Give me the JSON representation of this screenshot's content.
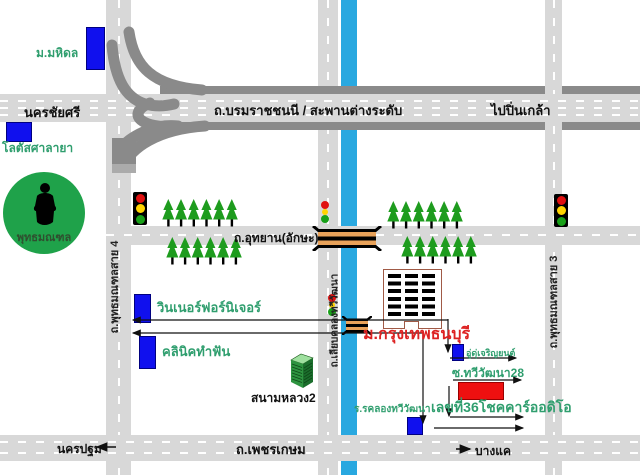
{
  "roads": {
    "nakhon_chai_si": "นครชัยศรี",
    "borommaratchachonnani": "ถ.บรมราชชนนี   /   สะพานต่างระดับ",
    "to_pin_klao": "ไปปิ่นเกล้า",
    "utthayan": "ถ.อุทยาน(อักษะ)",
    "phutthamonthon_sai_4": "ถ.พุทธมณฑลสาย 4",
    "phutthamonthon_sai_3": "ถ.พุทธมณฑลสาย 3",
    "liap_khlong_thawiwatthana": "ถ.เลียบคลองทวีวัฒนา",
    "phetkasem": "ถ.เพชรเกษม",
    "to_nakhon_pathom": "นครปฐม",
    "to_bang_khae": "บางแค"
  },
  "landmarks": {
    "mahidol_university": "ม.มหิดล",
    "lotus_salaya": "โลตัสศาลายา",
    "phutthamonthon": "พุทธมณฑล",
    "winner_furniture": "วินเนอร์ฟอร์นิเจอร์",
    "dental_clinic": "คลินิคทำฟัน",
    "sanam_luang_2": "สนามหลวง2",
    "bangkok_thonburi_university": "ม.กรุงเทพธนบุรี",
    "garage": "อู่ดุ่เจริญยนต์",
    "soi_thawiwatthana_28": "ซ.ทวีวัฒนา28",
    "no36_chok_car_audio": "เลขที่36โชคคาร์ออดิโอ",
    "khlong_thawiwatthana_school": "ร.รคลองทวีวัฒนา"
  },
  "icons": {
    "traffic_light": "red-yellow-green stacked circles",
    "pine_tree": "green triangle tree",
    "buddha_statue": "black silhouette in green circle",
    "bridge": "orange deck with black rails",
    "building_3d": "green isometric building"
  },
  "colors": {
    "canal_blue": "#29A8E0",
    "road_gray": "#D8D8D8",
    "highway_dark_gray": "#8A8A8A",
    "landmark_blue": "#1010EE",
    "destination_red": "#EE1010",
    "label_green": "#2F9E6E",
    "university_label_red": "#DD2222",
    "tree_green": "#1E9C1E",
    "buddha_circle_green": "#1FA24A",
    "bridge_orange": "#E8A25A"
  }
}
